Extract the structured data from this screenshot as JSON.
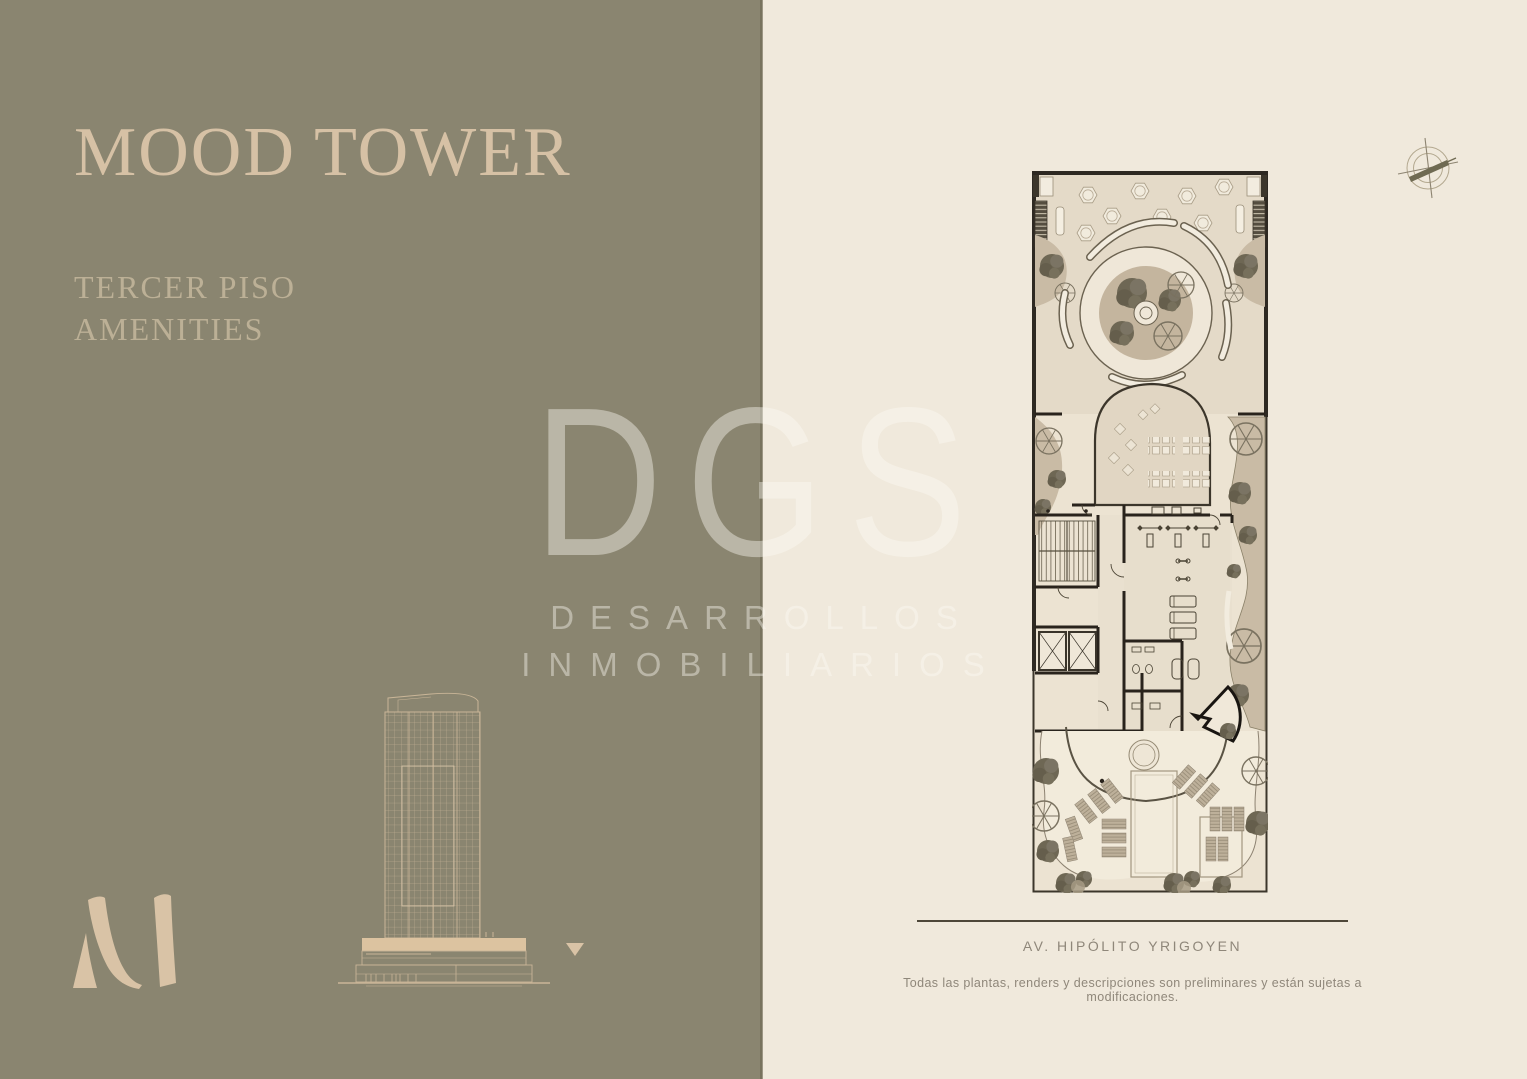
{
  "page": {
    "width": 1527,
    "height": 1079
  },
  "left_panel": {
    "title": "MOOD TOWER",
    "subtitle_lines": [
      "TERCER PISO",
      "AMENITIES"
    ],
    "monogram_icon": "m-monogram-icon",
    "tower_elevation_icon": "building-elevation-icon",
    "floor_marker_icon": "down-triangle-icon"
  },
  "watermark": {
    "acronym": "DGS",
    "line1": "DESARROLLOS",
    "line2": "INMOBILIARIOS"
  },
  "right_panel": {
    "compass_icon": "compass-north-icon",
    "floor_plan": "third-floor-amenities-plan",
    "street_label": "AV. HIPÓLITO YRIGOYEN",
    "disclaimer": "Todas las plantas, renders y descripciones son preliminares y están sujetas a modificaciones."
  },
  "colors": {
    "left_bg": "#8a8570",
    "right_bg": "#f0e9dc",
    "divider": "#6f6a55",
    "title_color": "#d6c1a5",
    "subtitle_color": "#bcb096",
    "accent_beige": "#d9c3a6",
    "watermark_color": "rgba(253,250,242,0.42)",
    "text_muted": "#8f877a",
    "line_dark": "#4e4739"
  }
}
